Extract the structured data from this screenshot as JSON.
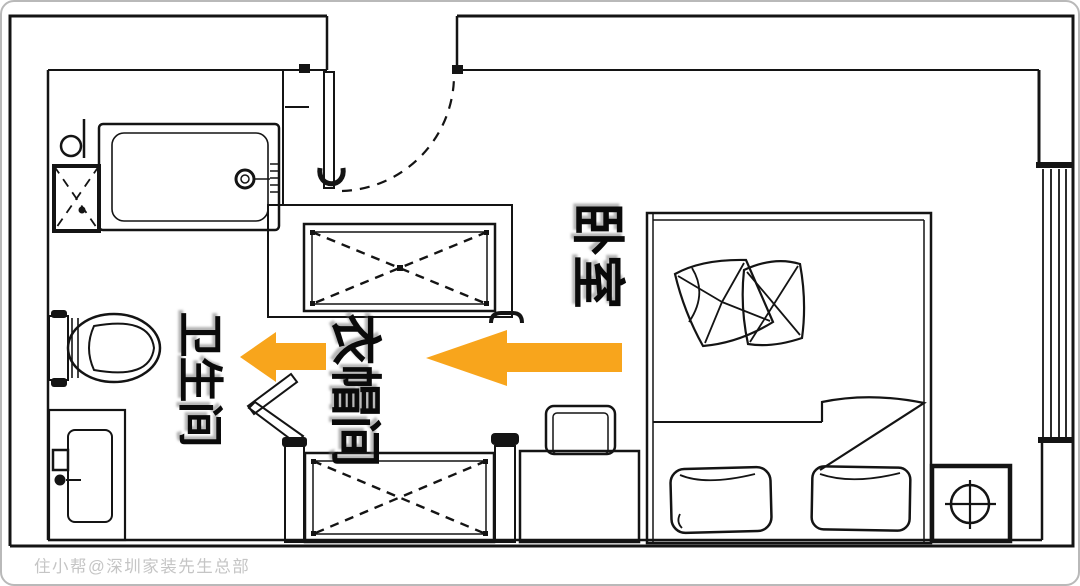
{
  "labels": {
    "bedroom": "卧室",
    "cloakroom": "衣帽间",
    "bathroom": "卫生间"
  },
  "watermark": "住小帮@深圳家装先生总部",
  "annotations": {
    "arrows": [
      {
        "id": "long",
        "direction": "left"
      },
      {
        "id": "short",
        "direction": "left"
      }
    ]
  },
  "colors": {
    "arrow": "#F8A51C",
    "line": "#141414",
    "label": "#0a0a0a",
    "watermark": "#c5c5c5"
  }
}
